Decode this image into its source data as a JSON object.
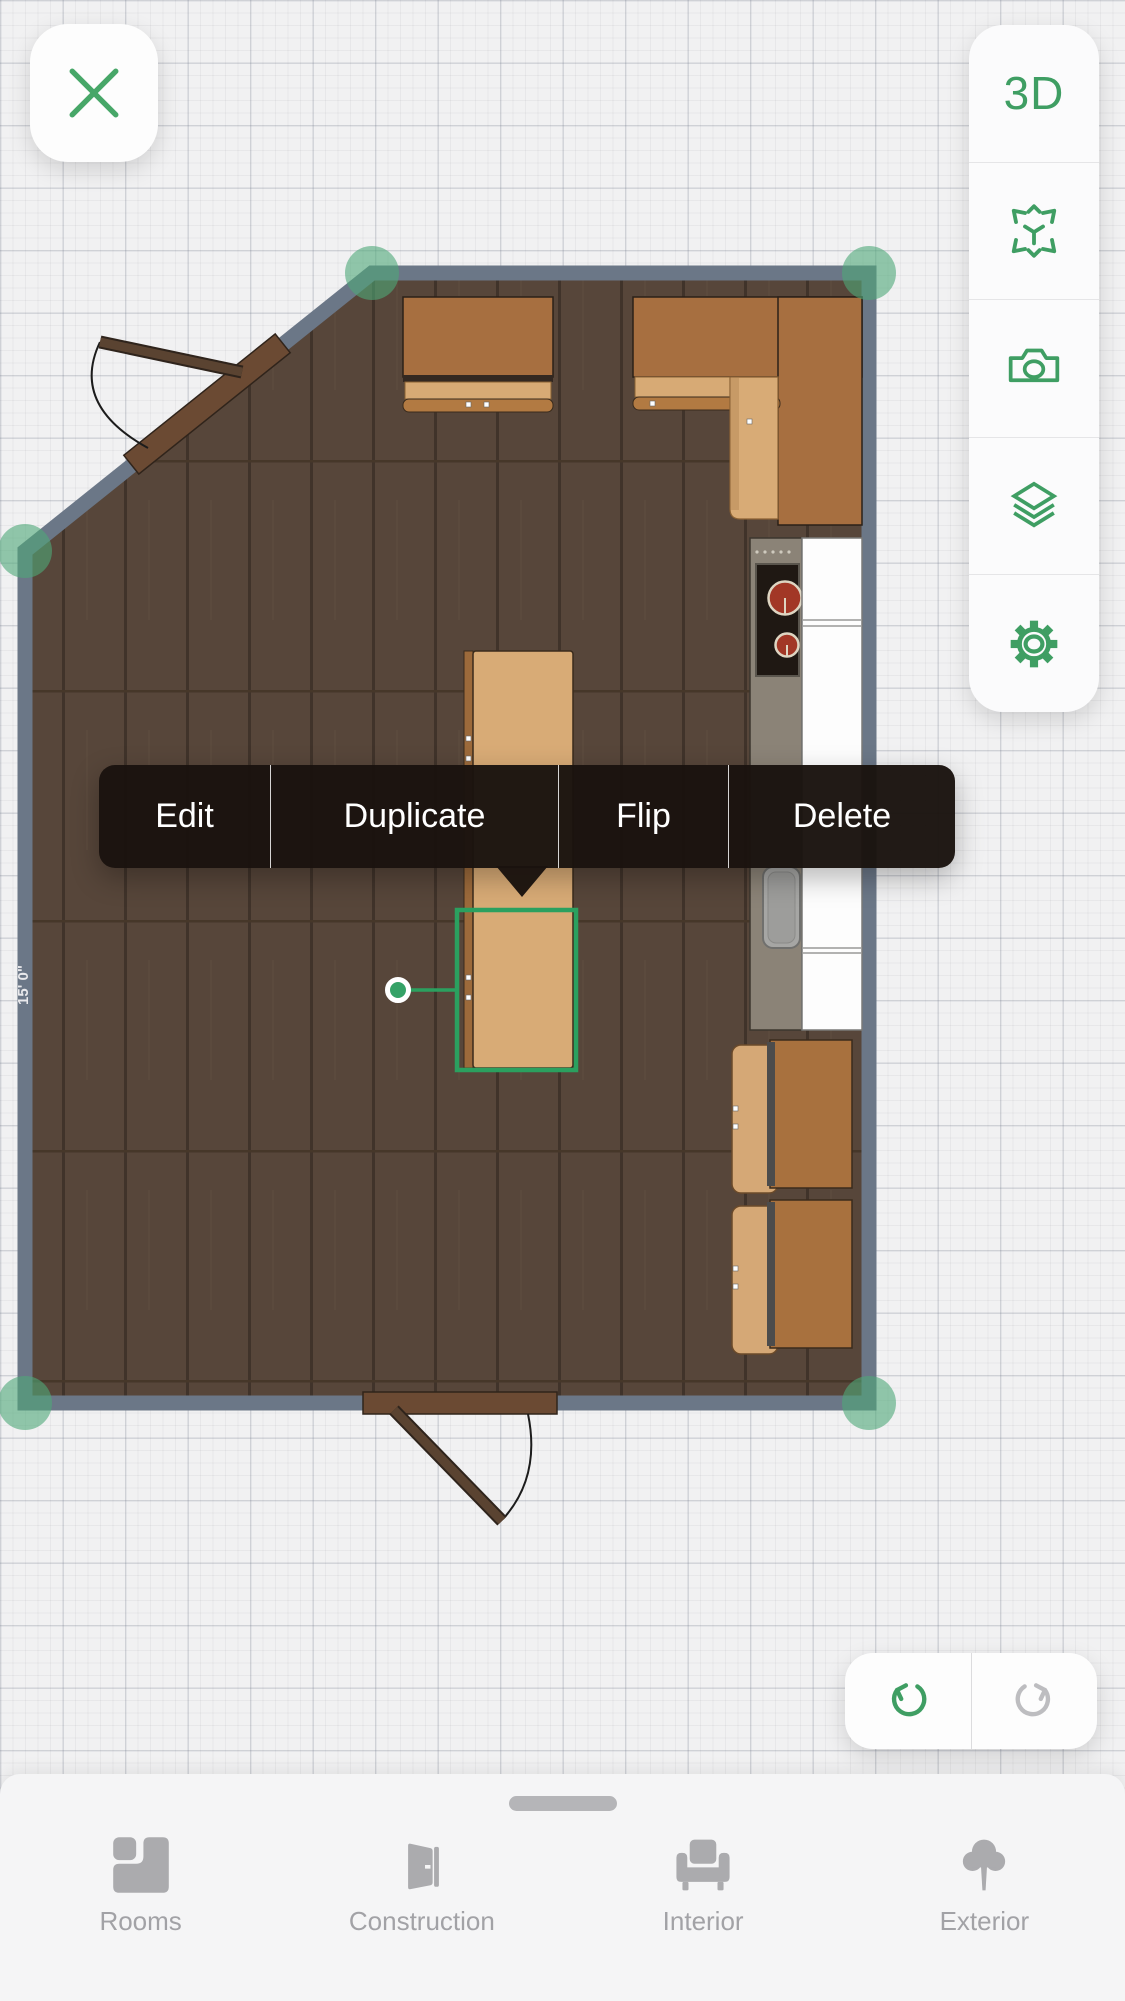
{
  "colors": {
    "accent_green": "#3f9e63",
    "selection_green": "#2ba05f",
    "wall_gray_blue": "#6b7787",
    "floor_wood": "#57463a",
    "menu_background": "#1a130e",
    "inactive_gray": "#a2a2a6"
  },
  "close_button": {
    "icon": "close-x"
  },
  "view_toolbar": {
    "buttons": [
      {
        "id": "3d-view",
        "label": "3D"
      },
      {
        "id": "ar-view",
        "icon": "ar-cube-arrows-icon"
      },
      {
        "id": "snapshot",
        "icon": "camera-icon"
      },
      {
        "id": "floors",
        "icon": "layers-icon"
      },
      {
        "id": "settings",
        "icon": "gear-icon"
      }
    ]
  },
  "context_menu": {
    "items": [
      {
        "label": "Edit"
      },
      {
        "label": "Duplicate"
      },
      {
        "label": "Flip"
      },
      {
        "label": "Delete"
      }
    ]
  },
  "room": {
    "dimension_label": "15' 0\""
  },
  "history_toolbar": {
    "undo": {
      "icon": "undo-arrow-icon",
      "enabled": true
    },
    "redo": {
      "icon": "redo-arrow-icon",
      "enabled": false
    }
  },
  "bottom_nav": {
    "tabs": [
      {
        "label": "Rooms",
        "icon": "rooms-icon"
      },
      {
        "label": "Construction",
        "icon": "door-icon"
      },
      {
        "label": "Interior",
        "icon": "armchair-icon"
      },
      {
        "label": "Exterior",
        "icon": "tree-icon"
      }
    ]
  }
}
